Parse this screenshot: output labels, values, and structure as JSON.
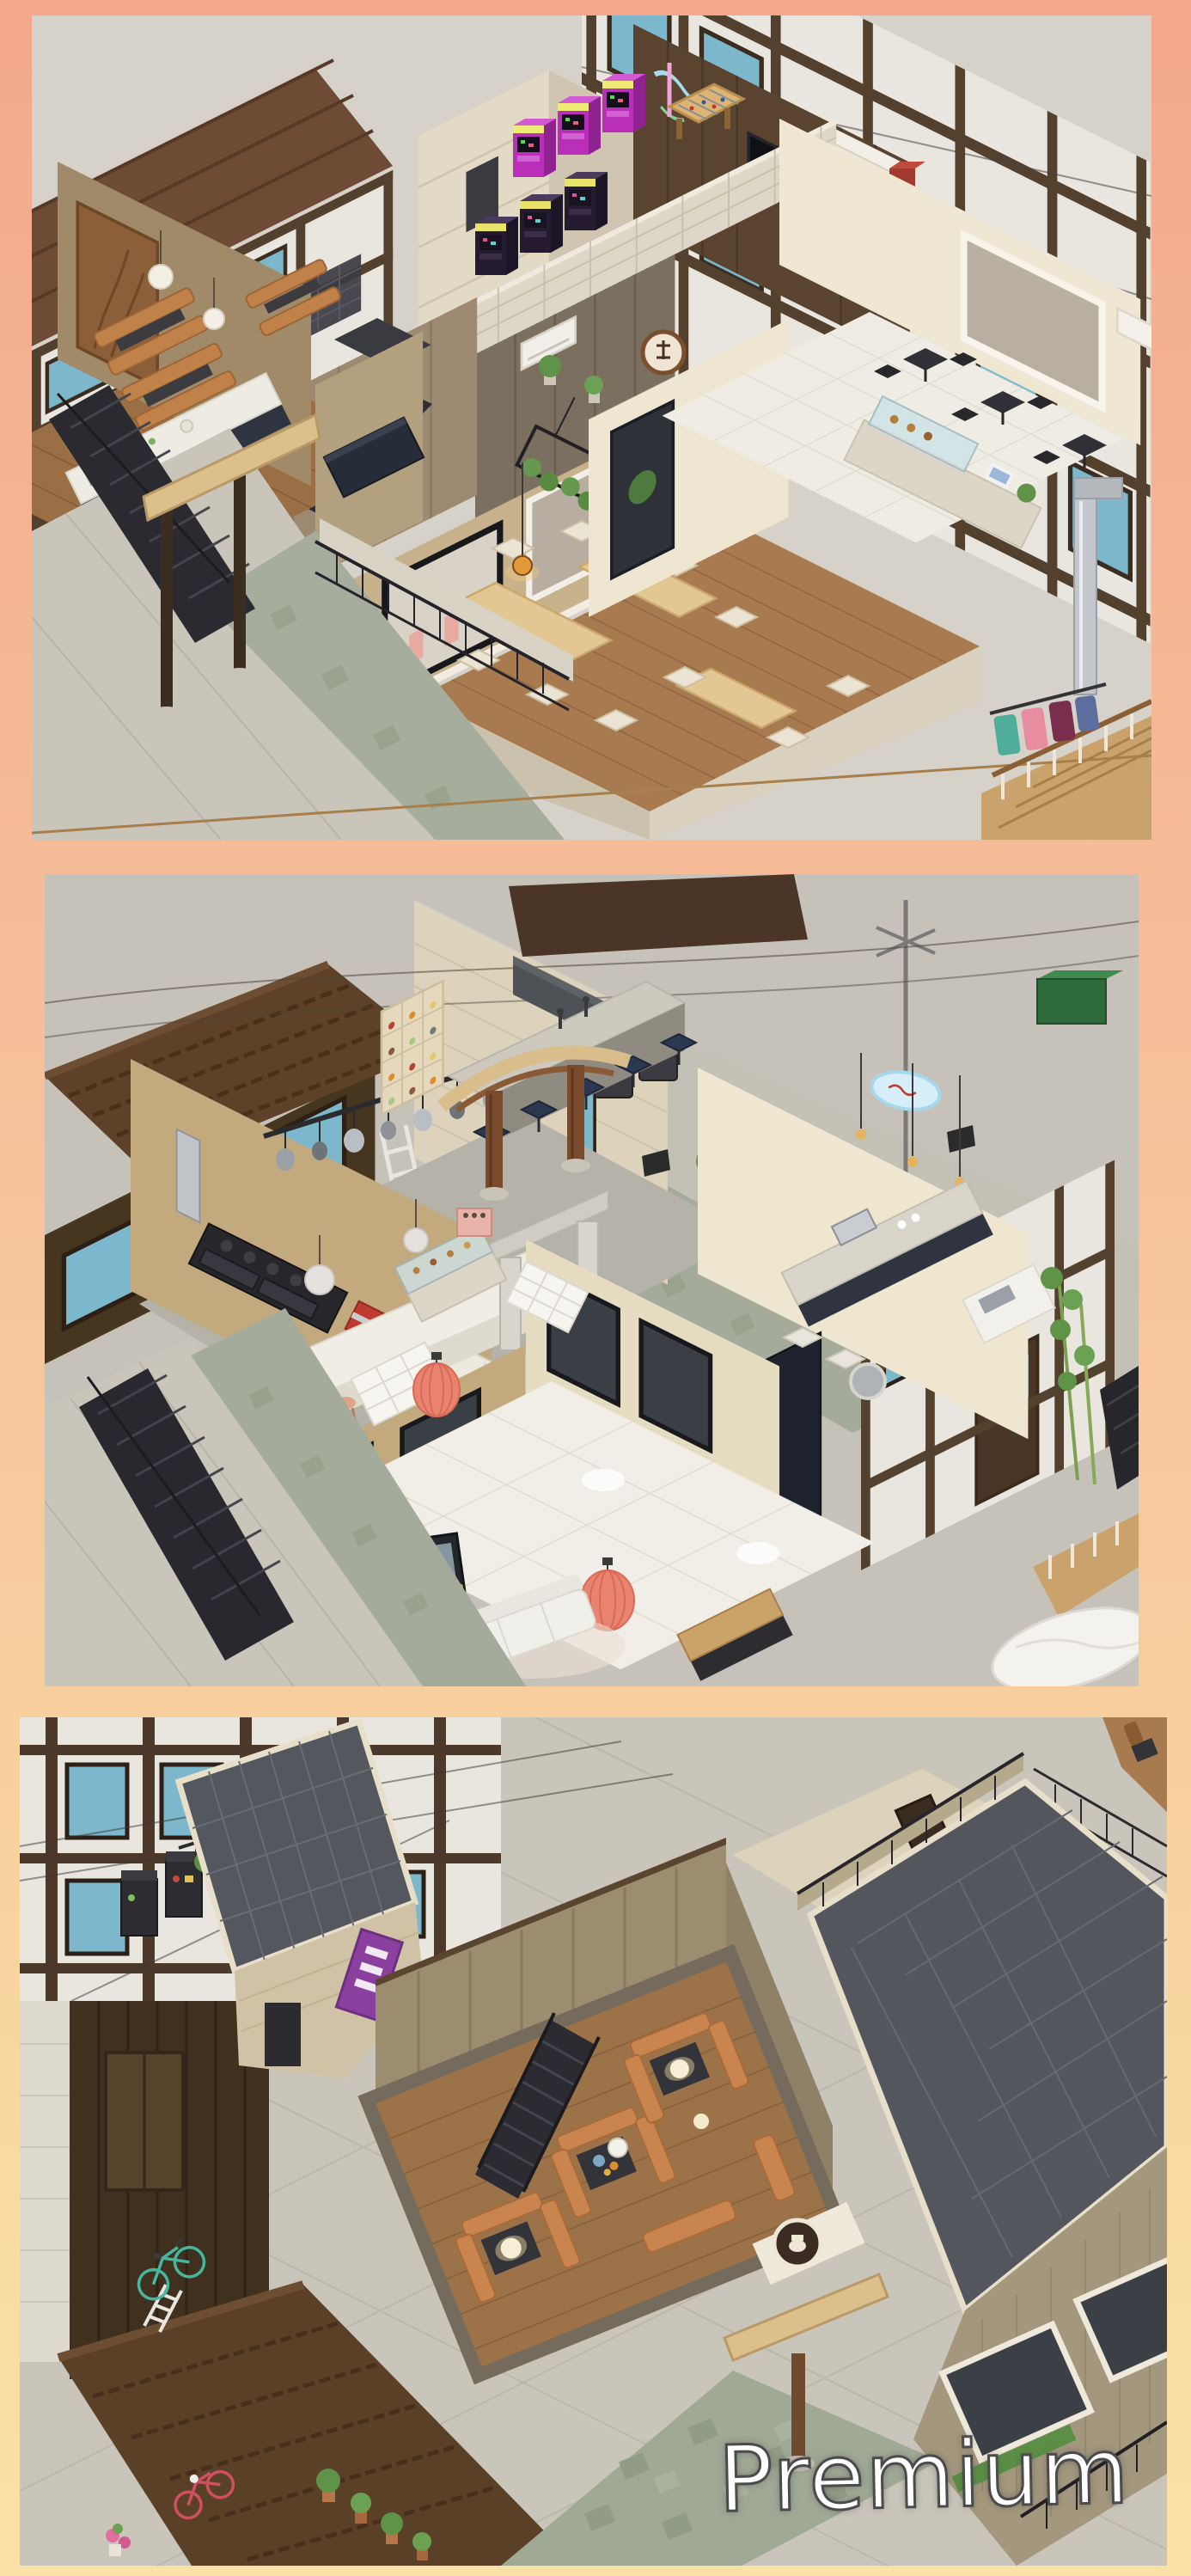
{
  "page": {
    "type": "game-screenshot-collage",
    "background": {
      "gradient_top": "#f3a78d",
      "gradient_middle": "#f7c89d",
      "gradient_bottom": "#f9e1a7"
    }
  },
  "watermark": {
    "text": "Premium",
    "fill": "#ffffff",
    "outline": "#4b4b4b"
  },
  "panels": [
    {
      "id": "panel-top",
      "scene": "isometric-interior-arcade-cafe-dining-floor"
    },
    {
      "id": "panel-middle",
      "scene": "isometric-interior-kitchen-bar-lounge-floor"
    },
    {
      "id": "panel-bottom",
      "scene": "isometric-exterior-street-and-rooftop-lounge"
    }
  ],
  "palette": {
    "arcade_magenta": "#b92fb9",
    "booth_leather": "#c0824a",
    "slate_roof": "#53575d",
    "terracotta_roof": "#5e4129",
    "window_sky_blue": "#7db7cb",
    "timber_brown": "#4c3929",
    "coral_lantern": "#e8836f",
    "cream_wall": "#efe6d2",
    "tan_wall": "#c2a97e"
  }
}
